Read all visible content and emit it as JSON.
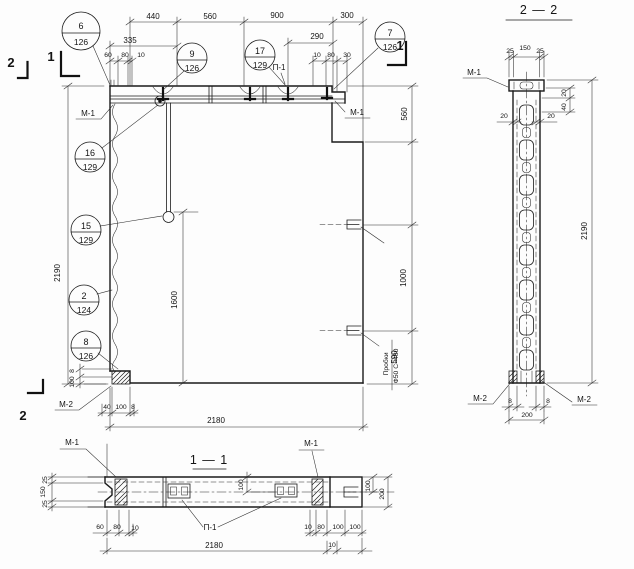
{
  "t": {
    "m1": "М-1",
    "m2": "М-2",
    "p1": "П-1",
    "s1": "1",
    "s2": "2",
    "note1": "Пробки",
    "note2": "Ф50 С=480"
  },
  "balloons": {
    "b6": {
      "n": "6",
      "d": "126"
    },
    "b9": {
      "n": "9",
      "d": "126"
    },
    "b17": {
      "n": "17",
      "d": "129"
    },
    "b7": {
      "n": "7",
      "d": "126"
    },
    "b16": {
      "n": "16",
      "d": "129"
    },
    "b15": {
      "n": "15",
      "d": "129"
    },
    "b2": {
      "n": "2",
      "d": "124"
    },
    "b8": {
      "n": "8",
      "d": "126"
    }
  },
  "main": {
    "top": [
      "440",
      "560",
      "900",
      "300"
    ],
    "sub": "335",
    "ltrio": [
      "60",
      "80",
      "10"
    ],
    "d290": "290",
    "rtrio": [
      "10",
      "80",
      "30"
    ],
    "height": "2190",
    "inner": "1600",
    "padv": [
      "8",
      "100"
    ],
    "padb": [
      "40",
      "100",
      "8"
    ],
    "width": "2180",
    "rcol": [
      "560",
      "1000",
      "590"
    ]
  },
  "sec22": {
    "title": "2 — 2",
    "trio": [
      "25",
      "150",
      "25"
    ],
    "w20l": "20",
    "w20r": "20",
    "side": [
      "20",
      "40"
    ],
    "height": "2190",
    "b8l": "8",
    "b8r": "8",
    "b200": "200"
  },
  "sec11": {
    "title": "1 — 1",
    "ltrio": [
      "25",
      "150",
      "25"
    ],
    "mid": "100",
    "end100": "100",
    "end200": "200",
    "bl": [
      "60",
      "80",
      "10"
    ],
    "br": [
      "10",
      "80",
      "100",
      "100"
    ],
    "b10": "10",
    "width": "2180"
  }
}
